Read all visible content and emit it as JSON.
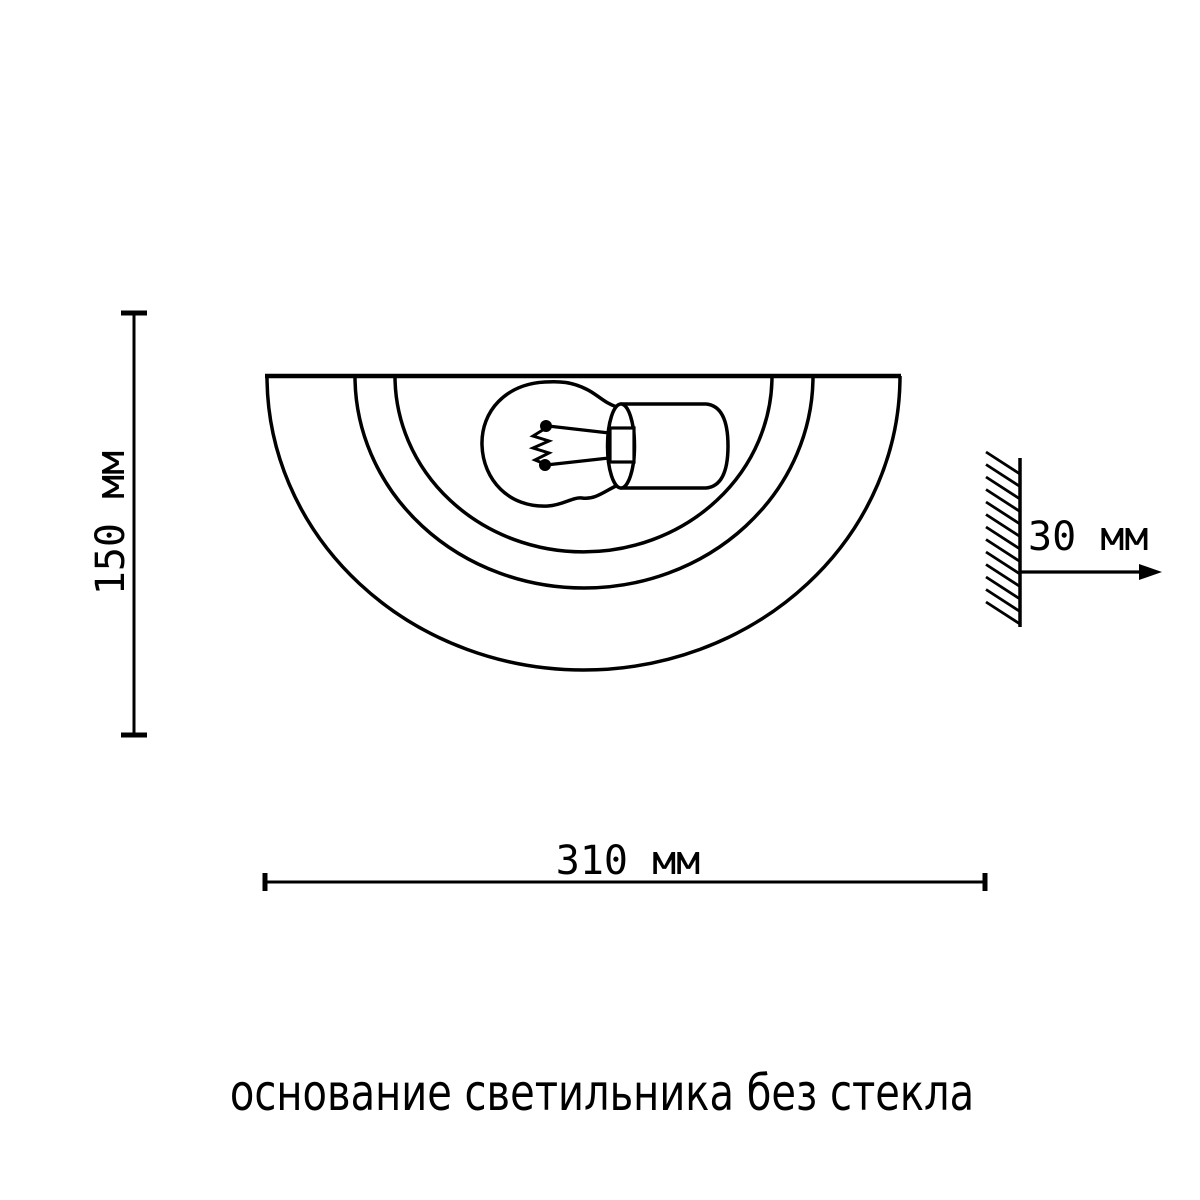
{
  "page": {
    "background_color": "#ffffff",
    "ink_color": "#000000",
    "kind": "product dimension diagram"
  },
  "labels": {
    "height": "150 мм",
    "width": "310 мм",
    "depth": "30 мм",
    "caption": "основание светильника без стекла"
  }
}
